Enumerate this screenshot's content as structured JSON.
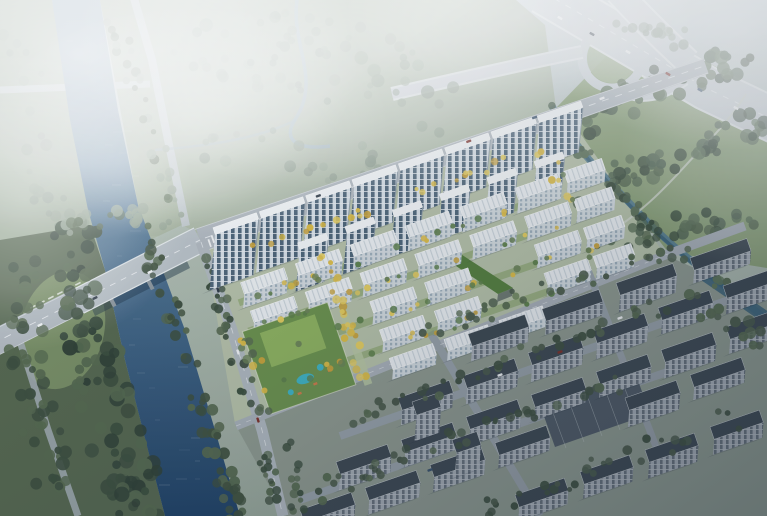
{
  "scene": {
    "description": "Aerial architectural rendering of a riverside residential development: staggered rows of white high-rise towers and low-rise housing blocks with autumn-yellow trees, a landscaped courtyard with swimming pool, a blue river crossed by a road bridge on the left, a misty highway interchange at the top right, a wooded park and canal, and existing gray apartment slabs in the shaded foreground.",
    "style": "photorealistic-masterplan-render",
    "landmarks": [
      "river",
      "road-bridge",
      "arterial-road",
      "highway-interchange",
      "new-residential-towers",
      "lowrise-housing-rows",
      "amenity-pool-courtyard",
      "northeast-park",
      "canal",
      "existing-gray-apartments",
      "riverbank-forest",
      "misty-creek-field"
    ],
    "approx_counts": {
      "highrise_towers": 14,
      "white_lowrise_buildings": 22,
      "existing_gray_buildings": 24
    },
    "palette": {
      "skyTop": "#c9d3da",
      "skyMid": "#aebbb0",
      "skyLow": "#9aa89c",
      "fieldHazy": "#abb8a6",
      "fieldWest": "#9fae9a",
      "stripGreen": "#a4b29d",
      "parkLawn": "#8ba178",
      "siteBase": "#b7c2aa",
      "grayBase": "#8f9a90",
      "forestBase": "#55664f",
      "clearing": "#7b9166",
      "waterTop": "#8fa8ba",
      "waterMid": "#5a7e9b",
      "waterDeep": "#1f4166",
      "canal": "#5c8292",
      "canalDeep": "#3a6078",
      "creek": "#9db4c2",
      "road": "#b0b8bf",
      "roadMinor": "#c3cbd1",
      "highway": "#ccd3d9",
      "highwayEdge": "#e2e7ea",
      "laneLine": "#eef1f4",
      "asphaltDark": "#4f5a66",
      "treeDark": "#3c4e3e",
      "treeMid": "#55684f",
      "treeLight": "#6a8257",
      "treeHazy": "#93a392",
      "autumn1": "#ddbc45",
      "autumn2": "#c9a23a",
      "autumn3": "#e6cd5e",
      "lawnStrip": "#83a15e",
      "spine": "#b9c8a2",
      "amenityDeck": "#6b924c",
      "amenityLawn": "#8fb35f",
      "pool": "#3fb3c4",
      "accentOrange": "#cf7a4a",
      "towerFacade": "#d8e0e7",
      "towerWin": "#4e6579",
      "towerRoof": "#f3f6f8",
      "towerFloor": "#e8edf1",
      "lowFacade": "#d4dbe0",
      "lowWin": "#9fb0bc",
      "lowRoof": "#edf0f3",
      "lowRoofStripe": "#ccd5dc",
      "greenRoof": "#567f3e",
      "grayRoof": "#3d4751",
      "grayFacade": "#a7aeb7",
      "grayWin": "#67707c",
      "grayCap": "#566070",
      "shadow": "#1d2936",
      "bridgeShadow": "#14293f",
      "carWhite": "#f2f4f6",
      "carDark": "#2f3a46",
      "carRed": "#7e2f28",
      "carBlue": "#39506b"
    }
  }
}
